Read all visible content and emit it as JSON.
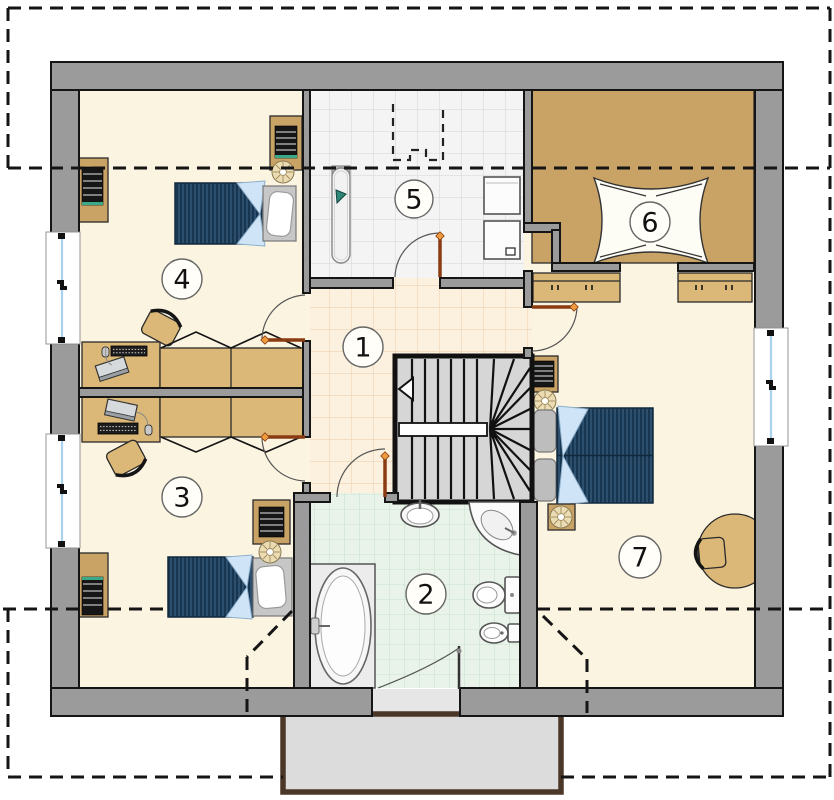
{
  "plan": {
    "title_hidden": "",
    "rooms": [
      {
        "label": "1"
      },
      {
        "label": "2"
      },
      {
        "label": "3"
      },
      {
        "label": "4"
      },
      {
        "label": "5"
      },
      {
        "label": "6"
      },
      {
        "label": "7"
      }
    ],
    "icons": {
      "stair_direction_arrow": "triangle-left"
    },
    "colors": {
      "wall": "#9b9b9b",
      "floor_cream": "#fbf4e1",
      "floor_hall": "#fcf0de",
      "hall_grid": "#f1d8ba",
      "floor_laundry": "#f4f4f4",
      "laundry_grid": "#dadada",
      "floor_bath": "#e9f3e9",
      "bath_grid": "#c9e3cd",
      "furniture_tan": "#dcb878",
      "cabinet_tan": "#c9a365",
      "bed_navy": "#2d4f6e",
      "bed_stripe": "#16334c",
      "blanket_blue": "#cfe4f6",
      "door_leaf": "#8a3b12",
      "door_arrow": "#ed9b3d",
      "balcony_floor": "#dcdcdc",
      "balcony_border": "#4b3728",
      "window_glass": "#a8d2ee",
      "stairs_fill": "#d6d6d6"
    }
  }
}
